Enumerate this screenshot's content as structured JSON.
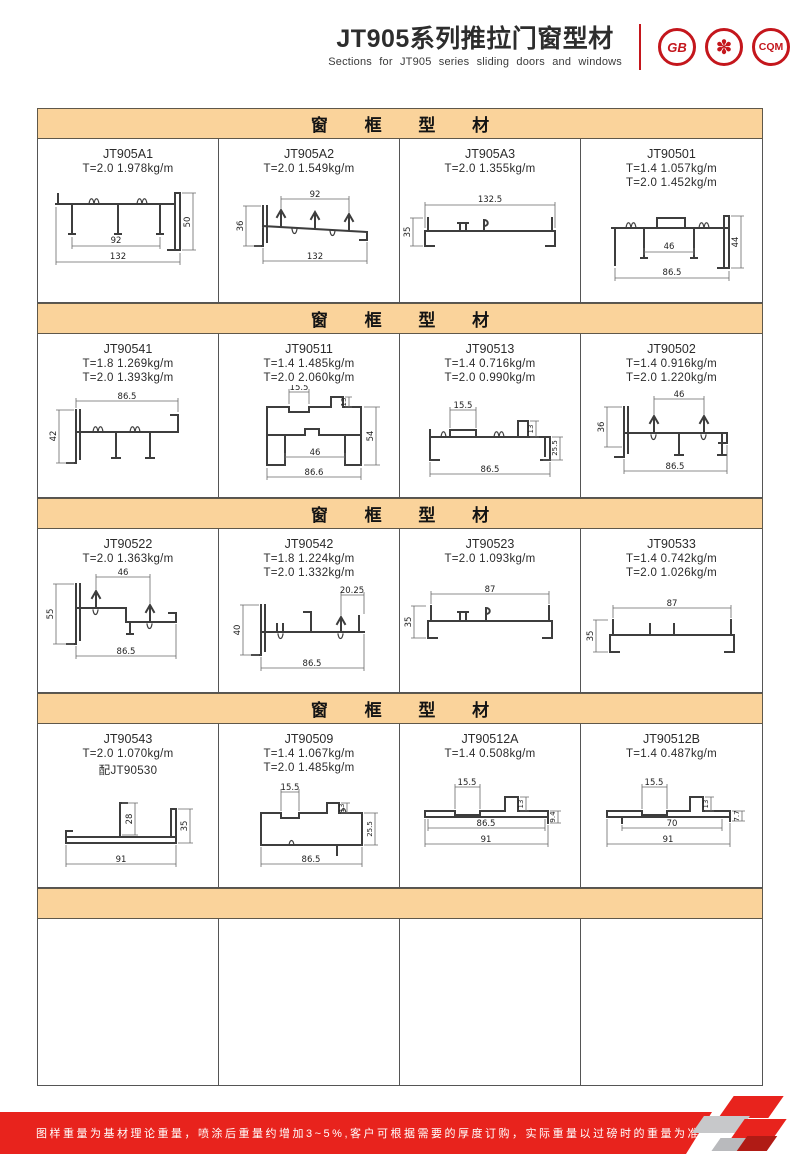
{
  "header": {
    "title": "JT905系列推拉门窗型材",
    "subtitle": "Sections for JT905 series sliding doors and windows",
    "logos": [
      {
        "name": "gb-certification-logo",
        "label": "GB"
      },
      {
        "name": "quality-emblem-logo",
        "label": "✽"
      },
      {
        "name": "cqm-certification-logo",
        "label": "CQM"
      }
    ]
  },
  "sections": [
    {
      "header": "窗 框 型 材",
      "cells": [
        {
          "code": "JT905A1",
          "specs": [
            "T=2.0  1.978kg/m"
          ],
          "dims": {
            "w_inner": "92",
            "w_outer": "132",
            "h": "50"
          }
        },
        {
          "code": "JT905A2",
          "specs": [
            "T=2.0  1.549kg/m"
          ],
          "dims": {
            "w_inner": "92",
            "w_outer": "132",
            "h": "36"
          }
        },
        {
          "code": "JT905A3",
          "specs": [
            "T=2.0  1.355kg/m"
          ],
          "dims": {
            "w": "132.5",
            "h": "35"
          }
        },
        {
          "code": "JT90501",
          "specs": [
            "T=1.4  1.057kg/m",
            "T=2.0  1.452kg/m"
          ],
          "dims": {
            "w_inner": "46",
            "w_outer": "86.5",
            "h": "44"
          }
        }
      ]
    },
    {
      "header": "窗 框 型 材",
      "cells": [
        {
          "code": "JT90541",
          "specs": [
            "T=1.8  1.269kg/m",
            "T=2.0  1.393kg/m"
          ],
          "dims": {
            "w": "86.5",
            "h": "42"
          }
        },
        {
          "code": "JT90511",
          "specs": [
            "T=1.4  1.485kg/m",
            "T=2.0  2.060kg/m"
          ],
          "dims": {
            "notch": "15.5",
            "tab": "13",
            "h": "54",
            "w_inner": "46",
            "w_outer": "86.6"
          }
        },
        {
          "code": "JT90513",
          "specs": [
            "T=1.4  0.716kg/m",
            "T=2.0  0.990kg/m"
          ],
          "dims": {
            "notch": "15.5",
            "tab": "13",
            "h": "25.5",
            "w": "86.5"
          }
        },
        {
          "code": "JT90502",
          "specs": [
            "T=1.4  0.916kg/m",
            "T=2.0  1.220kg/m"
          ],
          "dims": {
            "w_inner": "46",
            "h": "36",
            "w": "86.5"
          }
        }
      ]
    },
    {
      "header": "窗 框 型 材",
      "cells": [
        {
          "code": "JT90522",
          "specs": [
            "T=2.0  1.363kg/m"
          ],
          "dims": {
            "w_inner": "46",
            "h": "55",
            "w": "86.5"
          }
        },
        {
          "code": "JT90542",
          "specs": [
            "T=1.8  1.224kg/m",
            "T=2.0  1.332kg/m"
          ],
          "dims": {
            "tab": "20.25",
            "h": "40",
            "w": "86.5"
          }
        },
        {
          "code": "JT90523",
          "specs": [
            "T=2.0  1.093kg/m"
          ],
          "dims": {
            "w": "87",
            "h": "35"
          }
        },
        {
          "code": "JT90533",
          "specs": [
            "T=1.4  0.742kg/m",
            "T=2.0  1.026kg/m"
          ],
          "dims": {
            "w": "87",
            "h": "35"
          }
        }
      ]
    },
    {
      "header": "窗 框 型 材",
      "cells": [
        {
          "code": "JT90543",
          "specs": [
            "T=2.0  1.070kg/m",
            "配JT90530"
          ],
          "dims": {
            "up": "28",
            "h": "35",
            "w": "91"
          }
        },
        {
          "code": "JT90509",
          "specs": [
            "T=1.4  1.067kg/m",
            "T=2.0  1.485kg/m"
          ],
          "dims": {
            "notch": "15.5",
            "tab": "13",
            "h": "25.5",
            "w": "86.5"
          }
        },
        {
          "code": "JT90512A",
          "specs": [
            "T=1.4  0.508kg/m"
          ],
          "dims": {
            "notch": "15.5",
            "tab": "13",
            "h": "9.4",
            "w_inner": "86.5",
            "w": "91"
          }
        },
        {
          "code": "JT90512B",
          "specs": [
            "T=1.4  0.487kg/m"
          ],
          "dims": {
            "notch": "15.5",
            "tab": "13",
            "h": "7.7",
            "w_inner": "70",
            "w": "91"
          }
        }
      ]
    },
    {
      "header": "",
      "cells": []
    }
  ],
  "footer": {
    "note": "图样重量为基材理论重量，喷涂后重量约增加3~5%,客户可根据需要的厚度订购，实际重量以过磅时的重量为准。",
    "brand_line1": "JIAHUA",
    "brand_line2": "ALUMINIUM",
    "page_number": "03"
  }
}
